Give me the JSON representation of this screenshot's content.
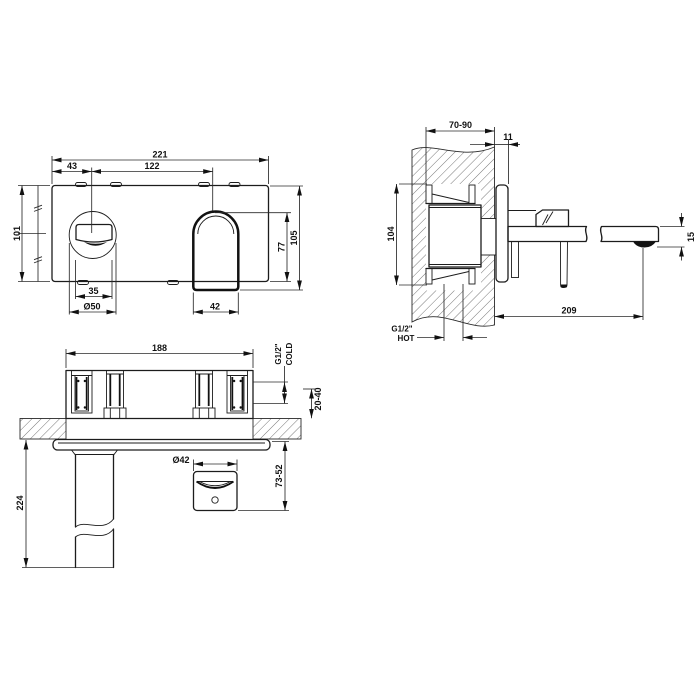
{
  "views": {
    "front": {
      "width": "221",
      "handle_offset_x": "43",
      "handle_to_spout": "122",
      "height_left": "101",
      "spout_top_to_plate_bottom": "77",
      "height": "105",
      "handle_cut_width": "35",
      "handle_trim_diameter": "Ø50",
      "spout_width": "42"
    },
    "side": {
      "wall_depth_range": "70-90",
      "plate_thickness": "11",
      "rough_in_height": "104",
      "spout_end_height": "15",
      "spout_reach": "209",
      "hot_inlet_size": "G1/2\"",
      "hot_inlet_label": "HOT"
    },
    "bottom": {
      "rough_in_width": "188",
      "cold_inlet_size": "G1/2\"",
      "cold_inlet_label": "COLD",
      "inlet_depth_range": "20-40",
      "spout_drop": "224",
      "handle_diameter": "Ø42",
      "handle_projection_range": "73-52"
    }
  }
}
